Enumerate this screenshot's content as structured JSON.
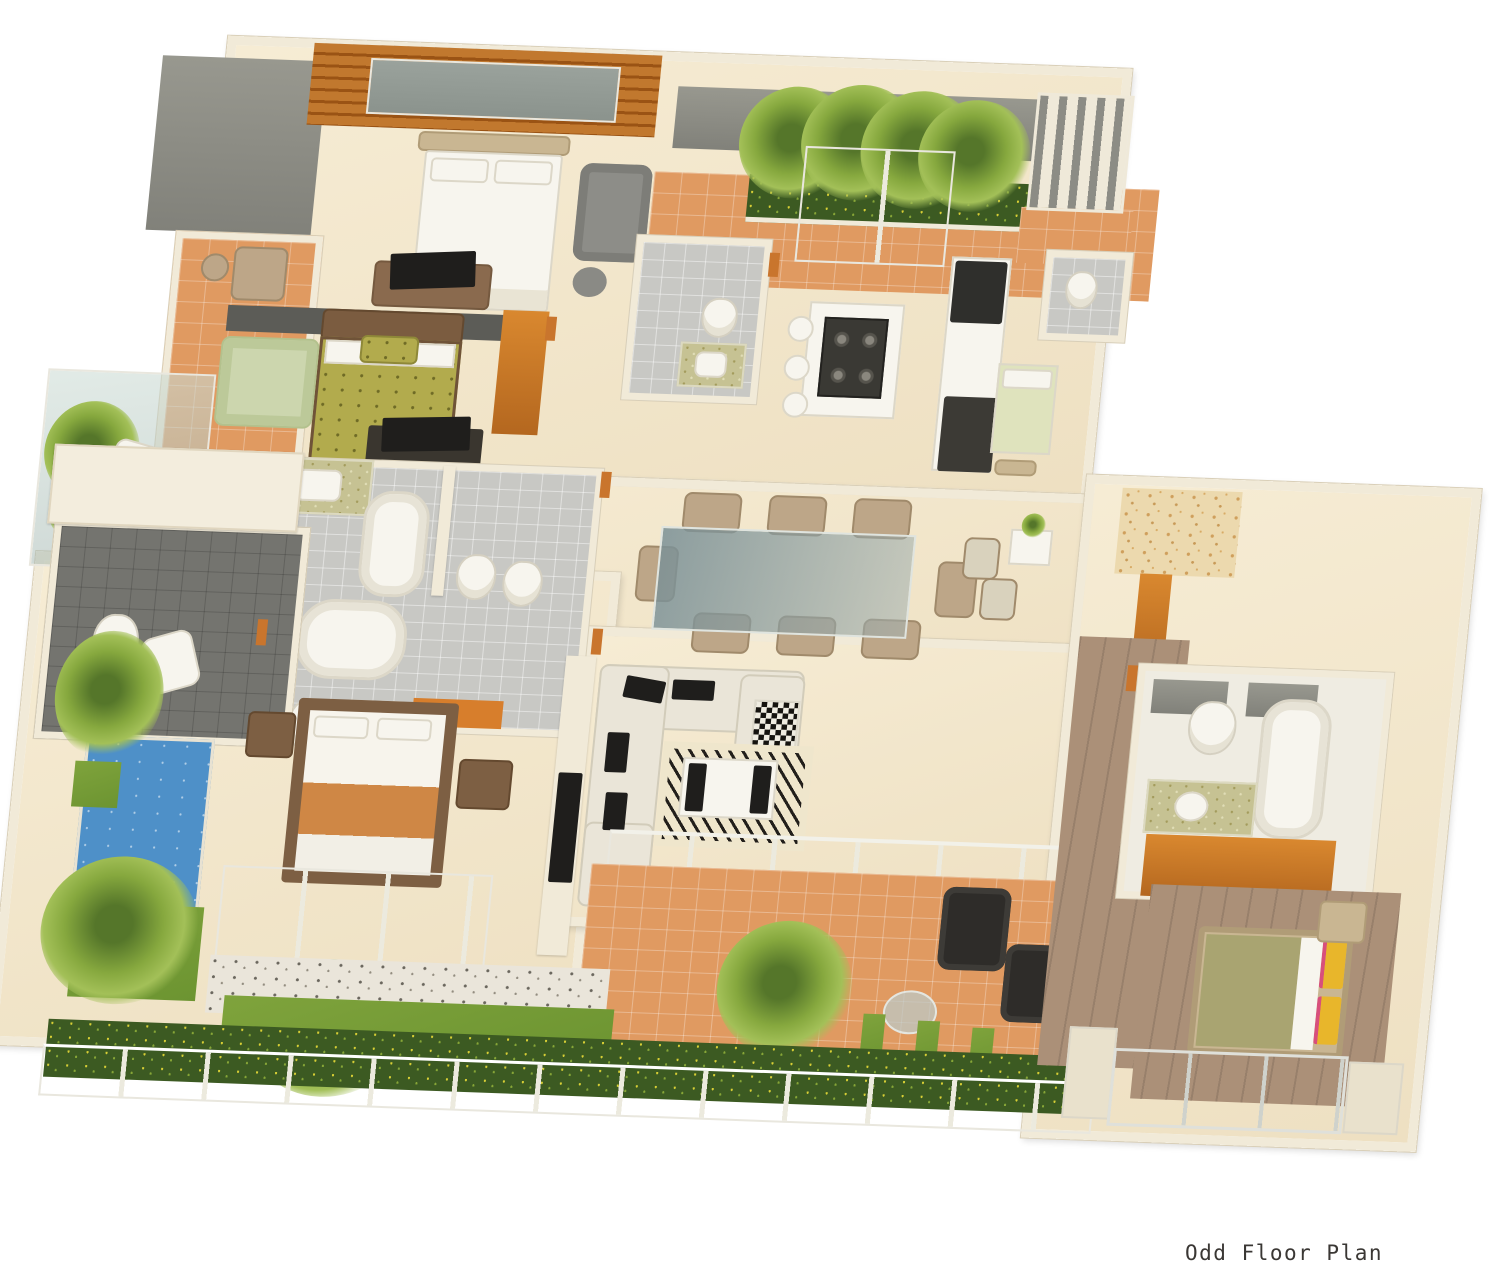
{
  "caption": {
    "text": "Odd Floor Plan"
  },
  "palette": {
    "wall": "#f1ead8",
    "wall-edge": "#d9cfb8",
    "floor-marble": "#f4e8cd",
    "floor-terracotta": "#e09a61",
    "floor-tile-gray": "#c8c8c4",
    "floor-slate": "#74746f",
    "floor-wood": "#ab9078",
    "wood-accent-wall": "#b4661f",
    "pool": "#4e90c8",
    "lawn": "#7fa33c",
    "hedge": "#3c5a22",
    "flower": "#d8cf35",
    "palm": "#86a83e",
    "sofa-cream": "#eae5d8",
    "furniture-black": "#2e2c29",
    "furniture-orange": "#d9882f",
    "olive-bedding": "#b2ab4d",
    "green-armchair": "#ccd6ae",
    "gray-armchair": "#8d8d88",
    "beige-chair": "#bda688",
    "white-fixture": "#f7f5ee",
    "green-counter": "#c6c293",
    "rug-orange": "#d77e2c",
    "rug-foyer": "#ecd9ae",
    "bed-orange-throw": "#cf8745",
    "yellow-pillow": "#e8b62b",
    "pink-trim": "#d84f7c",
    "glass": "#bccfc9",
    "caption": "#3a3734"
  },
  "inventory": {
    "zones": [
      "master-bedroom",
      "second-bedroom",
      "third-bedroom",
      "guest-bedroom",
      "maid-room",
      "kitchen",
      "dining-area",
      "living-room",
      "entry-terrace",
      "foyer",
      "master-bathroom",
      "guest-bathroom",
      "powder-room",
      "maid-toilet",
      "pool-deck",
      "balcony",
      "lower-terrace",
      "garden-strip",
      "wood-deck"
    ],
    "objects": [
      "double-bed",
      "single-bed",
      "bathtub",
      "jacuzzi-tub",
      "toilet",
      "bidet",
      "washbasin",
      "kitchen-island",
      "gas-hob",
      "bar-stool",
      "kitchen-counter",
      "dining-table",
      "dining-chair",
      "sectional-sofa",
      "coffee-table",
      "zebra-rug",
      "area-rug",
      "tv-unit",
      "wardrobe",
      "armchair",
      "ottoman",
      "swimming-pool",
      "palm-tree",
      "hedge-with-flowers",
      "lawn",
      "pebble-path",
      "glass-balustrade",
      "glass-sliding-door",
      "louvered-screen",
      "planter-box",
      "wood-slat-wall",
      "window"
    ]
  }
}
